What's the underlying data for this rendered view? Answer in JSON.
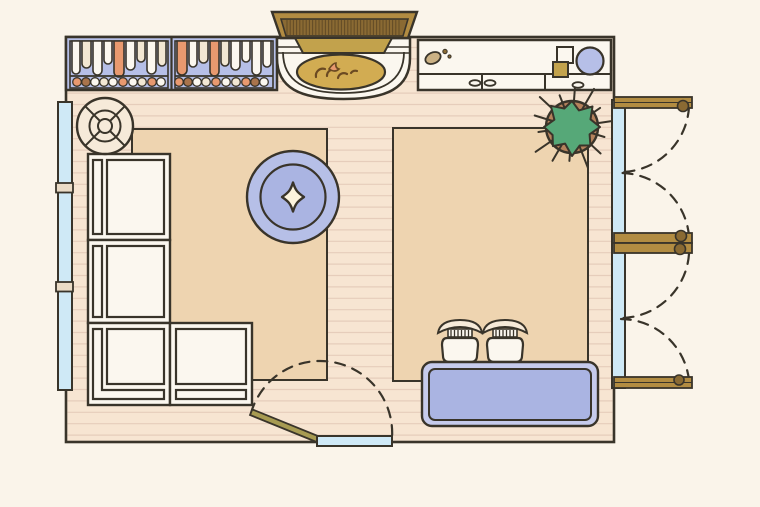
{
  "scene": {
    "type": "floor-plan-illustration",
    "room": "living-room",
    "view": "top-down"
  },
  "colors": {
    "background": "#faf4ea",
    "outline": "#39342a",
    "floor": "#f7e5d2",
    "plank_line": "#e6cdbb",
    "rug": "#eed4b0",
    "white": "#fbf7ef",
    "cream": "#f2e7d3",
    "cream2": "#f6ead9",
    "salmon": "#e8996f",
    "brown_book": "#a9744c",
    "periwinkle": "#b6bfe7",
    "periwinkle_deep": "#aab4e2",
    "periwinkle_light": "#c6cbec",
    "window_blue": "#cfe9f6",
    "wood": "#b28c42",
    "wood_dark": "#8a6a33",
    "gold": "#d2ac52",
    "khaki": "#c2a24c",
    "olive": "#a79b52",
    "green": "#56a878",
    "pot": "#b5825c",
    "flame": "#6b4a22",
    "mullion": "#eadbc6",
    "star_cream": "#fdf4dd",
    "tan": "#cbb184"
  },
  "furniture": [
    {
      "name": "bookshelf"
    },
    {
      "name": "fireplace"
    },
    {
      "name": "sideboard-counter"
    },
    {
      "name": "potted-plant"
    },
    {
      "name": "left-wall-window"
    },
    {
      "name": "right-wall-french-doors"
    },
    {
      "name": "bottom-entry-door"
    },
    {
      "name": "area-rug-left"
    },
    {
      "name": "area-rug-right"
    },
    {
      "name": "sectional-sofa"
    },
    {
      "name": "round-ottoman"
    },
    {
      "name": "round-side-table"
    },
    {
      "name": "stool-1"
    },
    {
      "name": "stool-2"
    },
    {
      "name": "coffee-table"
    }
  ],
  "bookshelf": {
    "sections": 2,
    "books": [
      {
        "x": 72,
        "w": 8,
        "h": 33,
        "c": "white"
      },
      {
        "x": 82,
        "w": 9,
        "h": 27,
        "c": "cream"
      },
      {
        "x": 93,
        "w": 9,
        "h": 34,
        "c": "white"
      },
      {
        "x": 104,
        "w": 8,
        "h": 23,
        "c": "white"
      },
      {
        "x": 114,
        "w": 10,
        "h": 36,
        "c": "salmon"
      },
      {
        "x": 126,
        "w": 9,
        "h": 29,
        "c": "white"
      },
      {
        "x": 137,
        "w": 8,
        "h": 21,
        "c": "cream"
      },
      {
        "x": 147,
        "w": 9,
        "h": 33,
        "c": "white"
      },
      {
        "x": 158,
        "w": 8,
        "h": 25,
        "c": "cream"
      },
      {
        "x": 177,
        "w": 10,
        "h": 34,
        "c": "salmon"
      },
      {
        "x": 189,
        "w": 8,
        "h": 26,
        "c": "white"
      },
      {
        "x": 199,
        "w": 9,
        "h": 22,
        "c": "cream"
      },
      {
        "x": 210,
        "w": 9,
        "h": 35,
        "c": "salmon"
      },
      {
        "x": 221,
        "w": 8,
        "h": 25,
        "c": "cream"
      },
      {
        "x": 231,
        "w": 9,
        "h": 29,
        "c": "white"
      },
      {
        "x": 242,
        "w": 8,
        "h": 21,
        "c": "white"
      },
      {
        "x": 252,
        "w": 9,
        "h": 34,
        "c": "white"
      },
      {
        "x": 263,
        "w": 8,
        "h": 26,
        "c": "white"
      }
    ],
    "shelf_items": [
      {
        "x": 77,
        "c": "salmon"
      },
      {
        "x": 86,
        "c": "brown_book"
      },
      {
        "x": 95,
        "c": "white"
      },
      {
        "x": 104,
        "c": "cream"
      },
      {
        "x": 113,
        "c": "white"
      },
      {
        "x": 123,
        "c": "salmon"
      },
      {
        "x": 133,
        "c": "white"
      },
      {
        "x": 142,
        "c": "cream"
      },
      {
        "x": 152,
        "c": "salmon"
      },
      {
        "x": 161,
        "c": "white"
      },
      {
        "x": 179,
        "c": "salmon"
      },
      {
        "x": 188,
        "c": "brown_book"
      },
      {
        "x": 197,
        "c": "white"
      },
      {
        "x": 206,
        "c": "cream"
      },
      {
        "x": 216,
        "c": "salmon"
      },
      {
        "x": 226,
        "c": "white"
      },
      {
        "x": 236,
        "c": "cream"
      },
      {
        "x": 246,
        "c": "salmon"
      },
      {
        "x": 255,
        "c": "brown_book"
      },
      {
        "x": 264,
        "c": "white"
      }
    ]
  }
}
